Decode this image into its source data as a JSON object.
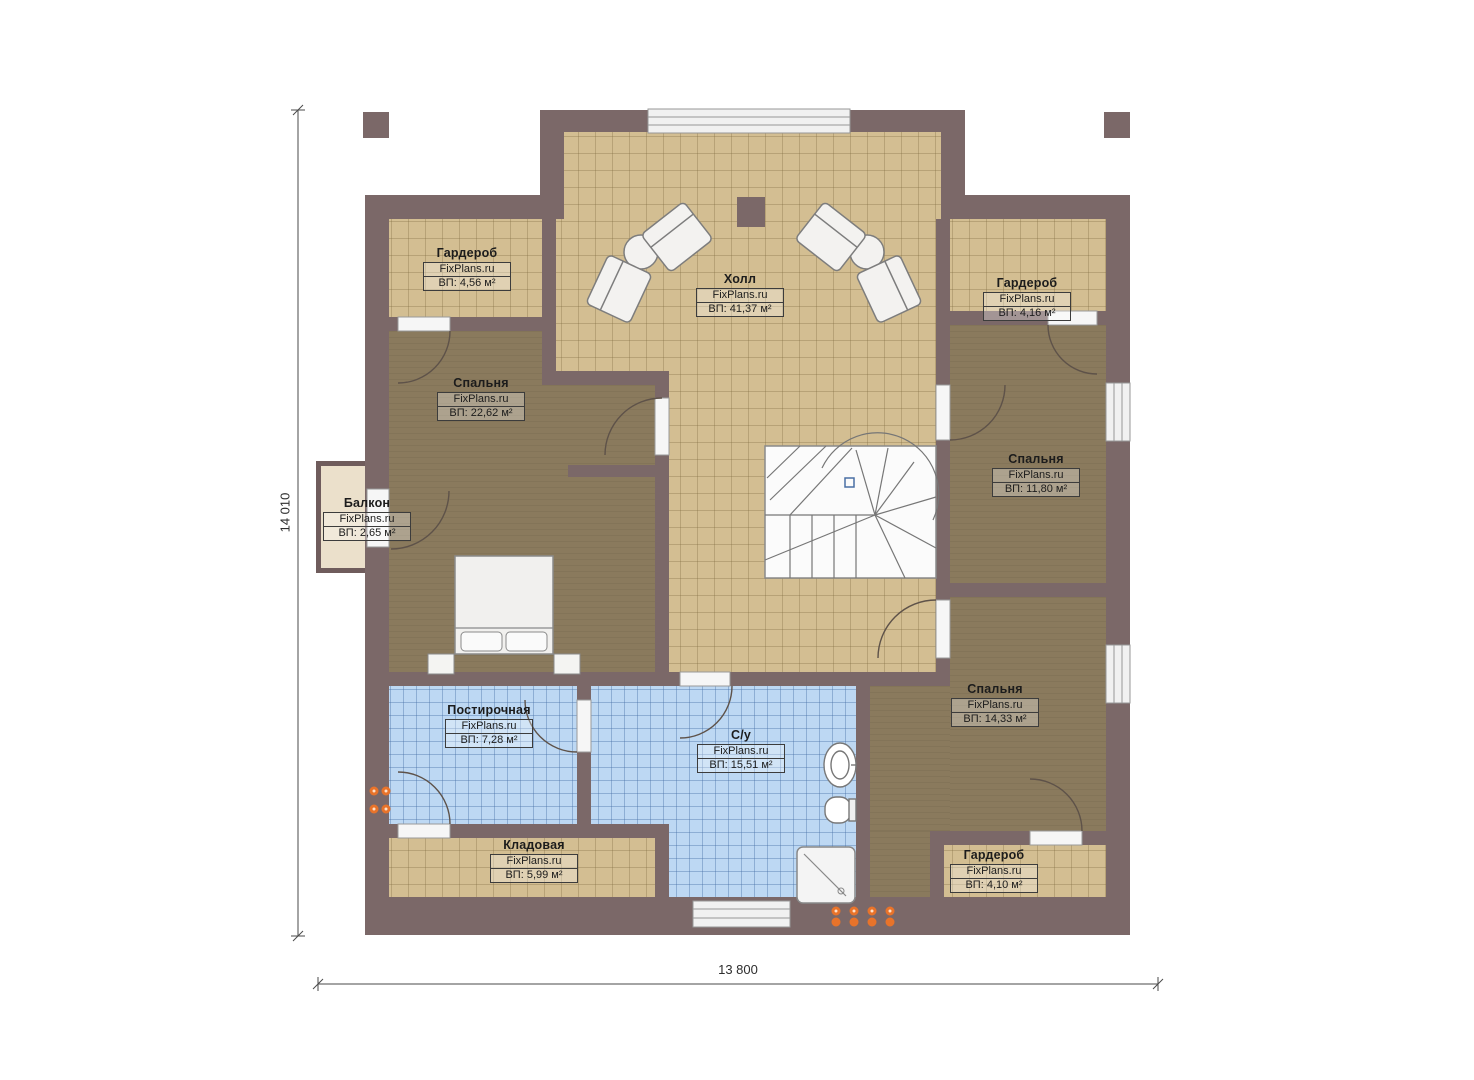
{
  "plan": {
    "watermark": "FixPlans.ru",
    "rooms": [
      {
        "key": "hall",
        "name": "Холл",
        "area": "ВП: 41,37 м²"
      },
      {
        "key": "wardrobe_top_left",
        "name": "Гардероб",
        "area": "ВП: 4,56 м²"
      },
      {
        "key": "wardrobe_top_right",
        "name": "Гардероб",
        "area": "ВП: 4,16 м²"
      },
      {
        "key": "bedroom_left",
        "name": "Спальня",
        "area": "ВП: 22,62 м²"
      },
      {
        "key": "bedroom_right",
        "name": "Спальня",
        "area": "ВП: 11,80 м²"
      },
      {
        "key": "bedroom_bottom_right",
        "name": "Спальня",
        "area": "ВП: 14,33 м²"
      },
      {
        "key": "balcony",
        "name": "Балкон",
        "area": "ВП: 2,65 м²"
      },
      {
        "key": "laundry",
        "name": "Постирочная",
        "area": "ВП: 7,28 м²"
      },
      {
        "key": "bathroom",
        "name": "С/у",
        "area": "ВП: 15,51 м²"
      },
      {
        "key": "storage",
        "name": "Кладовая",
        "area": "ВП: 5,99 м²"
      },
      {
        "key": "wardrobe_bottom_right",
        "name": "Гардероб",
        "area": "ВП: 4,10 м²"
      }
    ],
    "dimensions": {
      "horizontal": "13 800",
      "vertical": "14 010"
    },
    "colors": {
      "wall": "#7b6868",
      "tile_tan": "#d3be92",
      "carpet_brown": "#8a7a5d",
      "tile_blue": "#bdd8f3",
      "balcony_floor": "#ebe0cb",
      "radiator_orange": "#e8732a"
    }
  }
}
